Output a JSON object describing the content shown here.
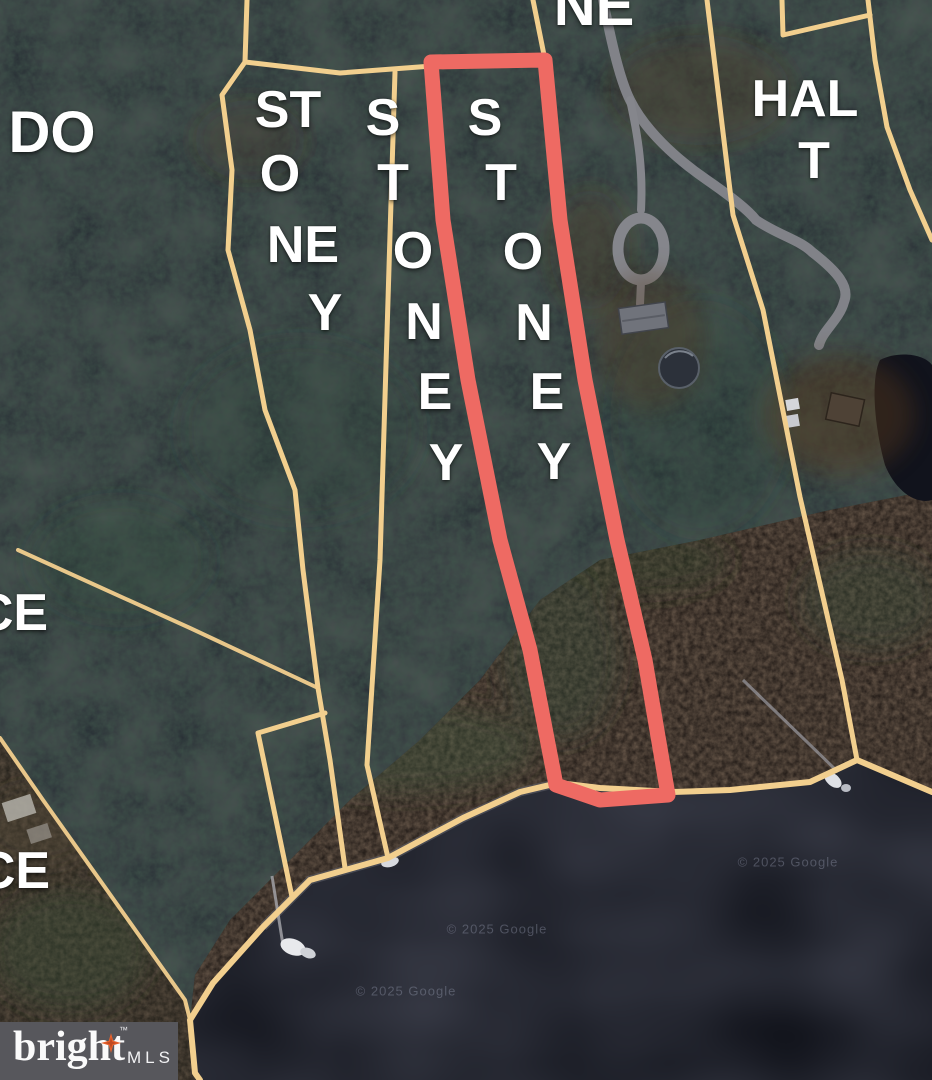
{
  "map": {
    "labels": [
      {
        "name": "road-label-do",
        "text": "DO"
      },
      {
        "name": "parcel1-letter-st",
        "text": "ST"
      },
      {
        "name": "parcel1-letter-o",
        "text": "O"
      },
      {
        "name": "parcel1-letter-ne",
        "text": "NE"
      },
      {
        "name": "parcel1-letter-y",
        "text": "Y"
      },
      {
        "name": "parcel2-letter-s",
        "text": "S"
      },
      {
        "name": "parcel2-letter-t",
        "text": "T"
      },
      {
        "name": "parcel2-letter-o",
        "text": "O"
      },
      {
        "name": "parcel2-letter-n",
        "text": "N"
      },
      {
        "name": "parcel2-letter-e",
        "text": "E"
      },
      {
        "name": "parcel2-letter-y",
        "text": "Y"
      },
      {
        "name": "parcel3-letter-s",
        "text": "S"
      },
      {
        "name": "parcel3-letter-t",
        "text": "T"
      },
      {
        "name": "parcel3-letter-o",
        "text": "O"
      },
      {
        "name": "parcel3-letter-n",
        "text": "N"
      },
      {
        "name": "parcel3-letter-e",
        "text": "E"
      },
      {
        "name": "parcel3-letter-y",
        "text": "Y"
      },
      {
        "name": "road-label-ne",
        "text": "NE"
      },
      {
        "name": "road-label-hal",
        "text": "HAL"
      },
      {
        "name": "road-label-t",
        "text": "T"
      },
      {
        "name": "road-label-ce-upper",
        "text": "CE"
      },
      {
        "name": "road-label-ce-lower",
        "text": "CE"
      }
    ],
    "watermark": {
      "text": "© 2025 Google"
    },
    "colors": {
      "parcel_line": "#f2cf8e",
      "highlight": "#ee6a63",
      "water": "#13151d",
      "road": "#85868c",
      "label": "#ffffff",
      "logo_bg": "#57575c",
      "star": "#e8622d"
    }
  },
  "logo": {
    "brand": "bright",
    "trademark": "™",
    "suffix": "MLS"
  }
}
